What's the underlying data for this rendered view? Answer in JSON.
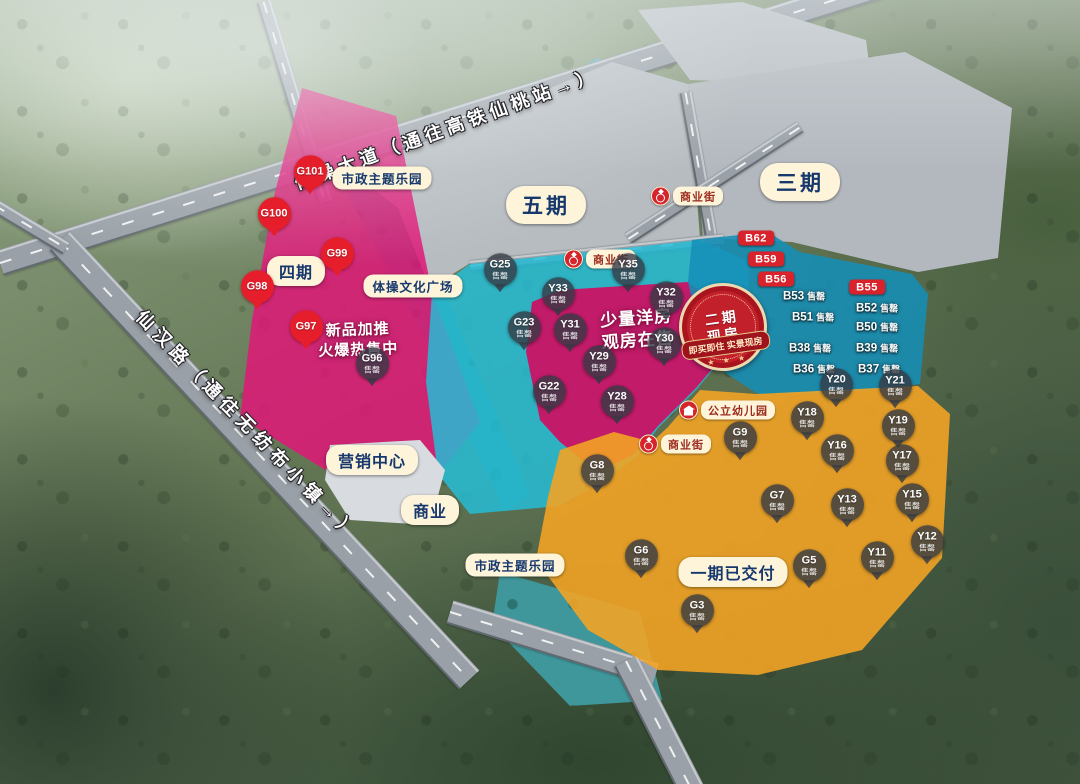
{
  "colors": {
    "label_bg": "#fdf4d9",
    "label_text": "#17386d",
    "icon_red": "#d5242c",
    "pin_red": "#e61e2b",
    "pin_gray": "rgba(52,57,68,0.8)",
    "chip_red": "#d8232d",
    "zone_pink": "#de1978",
    "zone_cyan": "#26bcd5",
    "zone_blue": "#158fb8",
    "zone_orange": "#f2a325"
  },
  "road_labels": [
    {
      "text": "体操大道（通往高铁仙桃站→）"
    },
    {
      "text": "仙汉路（通往无纺布小镇→）"
    }
  ],
  "zone_labels": [
    {
      "text": "市政主题乐园",
      "x": 382,
      "y": 178,
      "size": "sm"
    },
    {
      "text": "五期",
      "x": 546,
      "y": 205,
      "size": "lg"
    },
    {
      "text": "三期",
      "x": 800,
      "y": 182,
      "size": "lg"
    },
    {
      "text": "四期",
      "x": 296,
      "y": 271,
      "size": "md"
    },
    {
      "text": "体操文化广场",
      "x": 413,
      "y": 286,
      "size": "sm"
    },
    {
      "text": "营销中心",
      "x": 372,
      "y": 460,
      "size": "md"
    },
    {
      "text": "商业",
      "x": 430,
      "y": 510,
      "size": "md"
    },
    {
      "text": "市政主题乐园",
      "x": 515,
      "y": 565,
      "size": "sm"
    },
    {
      "text": "一期已交付",
      "x": 733,
      "y": 572,
      "size": "md"
    }
  ],
  "icon_labels": [
    {
      "text": "商业街",
      "icon": "ring",
      "x": 573,
      "y": 259
    },
    {
      "text": "商业街",
      "icon": "ring",
      "x": 660,
      "y": 196
    },
    {
      "text": "商业街",
      "icon": "ring",
      "x": 648,
      "y": 444
    },
    {
      "text": "公立幼儿园",
      "icon": "school",
      "x": 688,
      "y": 410
    }
  ],
  "promos": [
    {
      "lines": [
        "新品加推",
        "火爆热售中"
      ],
      "x": 358,
      "y": 340,
      "size": 15,
      "rot": -2
    },
    {
      "lines": [
        "少量洋房",
        "观房在售"
      ],
      "x": 637,
      "y": 330,
      "size": 17,
      "rot": -4
    }
  ],
  "badge": {
    "line1": "二期",
    "line2": "现房",
    "ribbon": "即买即住 实景现房",
    "stars": "★ ★ ★"
  },
  "markers": [
    {
      "id": "G101",
      "status": "",
      "style": "pin-red",
      "x": 310,
      "y": 180
    },
    {
      "id": "G100",
      "status": "",
      "style": "pin-red",
      "x": 274,
      "y": 222
    },
    {
      "id": "G99",
      "status": "",
      "style": "pin-red",
      "x": 337,
      "y": 262
    },
    {
      "id": "G98",
      "status": "",
      "style": "pin-red",
      "x": 257,
      "y": 295
    },
    {
      "id": "G97",
      "status": "",
      "style": "pin-red",
      "x": 306,
      "y": 335
    },
    {
      "id": "G96",
      "status": "售罄",
      "style": "pin-gray",
      "x": 372,
      "y": 372
    },
    {
      "id": "G25",
      "status": "售罄",
      "style": "pin-gray",
      "x": 500,
      "y": 278
    },
    {
      "id": "Y35",
      "status": "售罄",
      "style": "pin-gray",
      "x": 628,
      "y": 278
    },
    {
      "id": "Y33",
      "status": "售罄",
      "style": "pin-gray",
      "x": 558,
      "y": 302
    },
    {
      "id": "Y32",
      "status": "售罄",
      "style": "pin-gray",
      "x": 666,
      "y": 306
    },
    {
      "id": "G23",
      "status": "售罄",
      "style": "pin-gray",
      "x": 524,
      "y": 336
    },
    {
      "id": "Y31",
      "status": "售罄",
      "style": "pin-gray",
      "x": 570,
      "y": 338
    },
    {
      "id": "Y30",
      "status": "售罄",
      "style": "pin-gray",
      "x": 664,
      "y": 352
    },
    {
      "id": "Y29",
      "status": "售罄",
      "style": "pin-gray",
      "x": 599,
      "y": 370
    },
    {
      "id": "G22",
      "status": "售罄",
      "style": "pin-gray",
      "x": 549,
      "y": 400
    },
    {
      "id": "Y28",
      "status": "售罄",
      "style": "pin-gray",
      "x": 617,
      "y": 410
    },
    {
      "id": "B62",
      "status": "",
      "style": "chip-red",
      "x": 756,
      "y": 238
    },
    {
      "id": "B59",
      "status": "",
      "style": "chip-red",
      "x": 766,
      "y": 259
    },
    {
      "id": "B56",
      "status": "",
      "style": "chip-red",
      "x": 776,
      "y": 279
    },
    {
      "id": "B55",
      "status": "",
      "style": "chip-red",
      "x": 867,
      "y": 287
    },
    {
      "id": "B53",
      "status": "售罄",
      "style": "flat",
      "x": 783,
      "y": 296
    },
    {
      "id": "B51",
      "status": "售罄",
      "style": "flat",
      "x": 792,
      "y": 317
    },
    {
      "id": "B38",
      "status": "售罄",
      "style": "flat",
      "x": 789,
      "y": 348
    },
    {
      "id": "B36",
      "status": "售罄",
      "style": "flat",
      "x": 793,
      "y": 369
    },
    {
      "id": "B52",
      "status": "售罄",
      "style": "flat",
      "x": 856,
      "y": 308
    },
    {
      "id": "B50",
      "status": "售罄",
      "style": "flat",
      "x": 856,
      "y": 327
    },
    {
      "id": "B39",
      "status": "售罄",
      "style": "flat",
      "x": 856,
      "y": 348
    },
    {
      "id": "B37",
      "status": "售罄",
      "style": "flat",
      "x": 858,
      "y": 369
    },
    {
      "id": "G9",
      "status": "售罄",
      "style": "pin-gray",
      "x": 740,
      "y": 446
    },
    {
      "id": "Y20",
      "status": "售罄",
      "style": "pin-gray",
      "x": 836,
      "y": 393
    },
    {
      "id": "Y21",
      "status": "售罄",
      "style": "pin-gray",
      "x": 895,
      "y": 394
    },
    {
      "id": "Y18",
      "status": "售罄",
      "style": "pin-gray",
      "x": 807,
      "y": 426
    },
    {
      "id": "Y19",
      "status": "售罄",
      "style": "pin-gray",
      "x": 898,
      "y": 434
    },
    {
      "id": "Y16",
      "status": "售罄",
      "style": "pin-gray",
      "x": 837,
      "y": 459
    },
    {
      "id": "Y17",
      "status": "售罄",
      "style": "pin-gray",
      "x": 902,
      "y": 469
    },
    {
      "id": "G8",
      "status": "售罄",
      "style": "pin-gray",
      "x": 597,
      "y": 479
    },
    {
      "id": "G7",
      "status": "售罄",
      "style": "pin-gray",
      "x": 777,
      "y": 509
    },
    {
      "id": "Y13",
      "status": "售罄",
      "style": "pin-gray",
      "x": 847,
      "y": 513
    },
    {
      "id": "Y15",
      "status": "售罄",
      "style": "pin-gray",
      "x": 912,
      "y": 508
    },
    {
      "id": "G6",
      "status": "售罄",
      "style": "pin-gray",
      "x": 641,
      "y": 564
    },
    {
      "id": "Y11",
      "status": "售罄",
      "style": "pin-gray",
      "x": 877,
      "y": 566
    },
    {
      "id": "Y12",
      "status": "售罄",
      "style": "pin-gray",
      "x": 927,
      "y": 550
    },
    {
      "id": "G5",
      "status": "售罄",
      "style": "pin-gray",
      "x": 809,
      "y": 574
    },
    {
      "id": "G3",
      "status": "售罄",
      "style": "pin-gray",
      "x": 697,
      "y": 619
    }
  ]
}
